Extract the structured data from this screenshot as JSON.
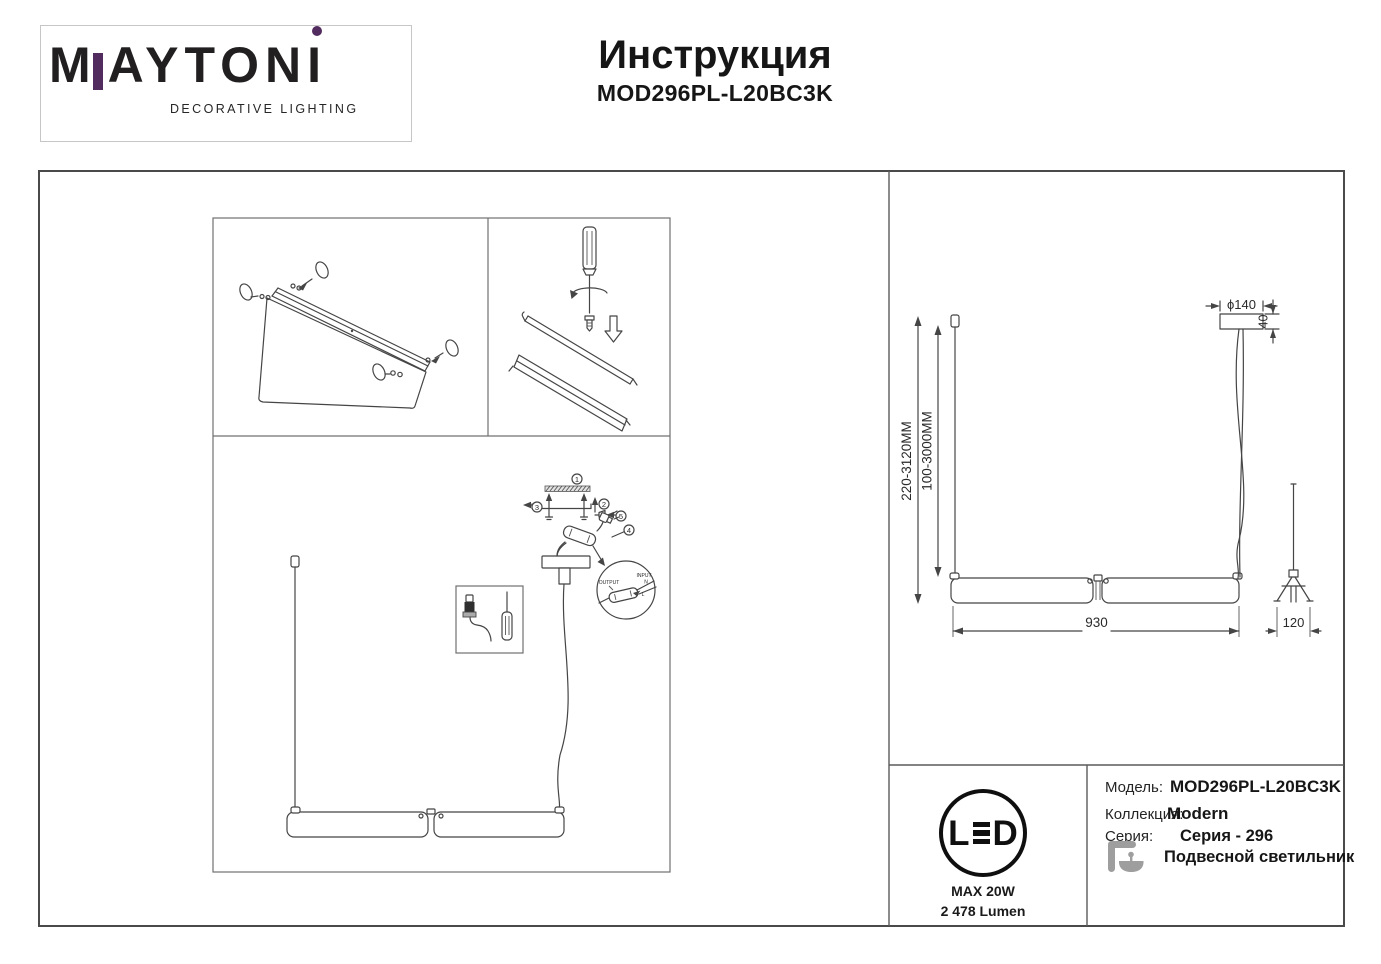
{
  "brand": {
    "wordmark_m": "M",
    "wordmark_rest": "AYTON",
    "wordmark_i": "I",
    "tagline": "DECORATIVE LIGHTING",
    "accent_purple": "#522b5f"
  },
  "header": {
    "title": "Инструкция",
    "model": "MOD296PL-L20BC3K"
  },
  "steps": [
    "1",
    "2",
    "3",
    "4",
    "5"
  ],
  "wiring": {
    "output": "OUTPUT",
    "input": "INPUT",
    "n": "N",
    "l": "L"
  },
  "dims": {
    "overall": "220-3120MM",
    "suspension": "100-3000MM",
    "canopy_diameter": "ϕ140",
    "canopy_height": "40",
    "length": "930",
    "width": "120"
  },
  "badge": {
    "led_l": "L",
    "led_d": "D",
    "power": "MAX 20W",
    "lumen": "2 478 Lumen"
  },
  "info": {
    "model_label": "Модель:",
    "model_value": "MOD296PL-L20BC3K",
    "collection_label": "Коллекция:",
    "collection_value": "Modern",
    "series_label": "Серия:",
    "series_value": "Серия - 296",
    "type_value": "Подвесной светильник"
  }
}
